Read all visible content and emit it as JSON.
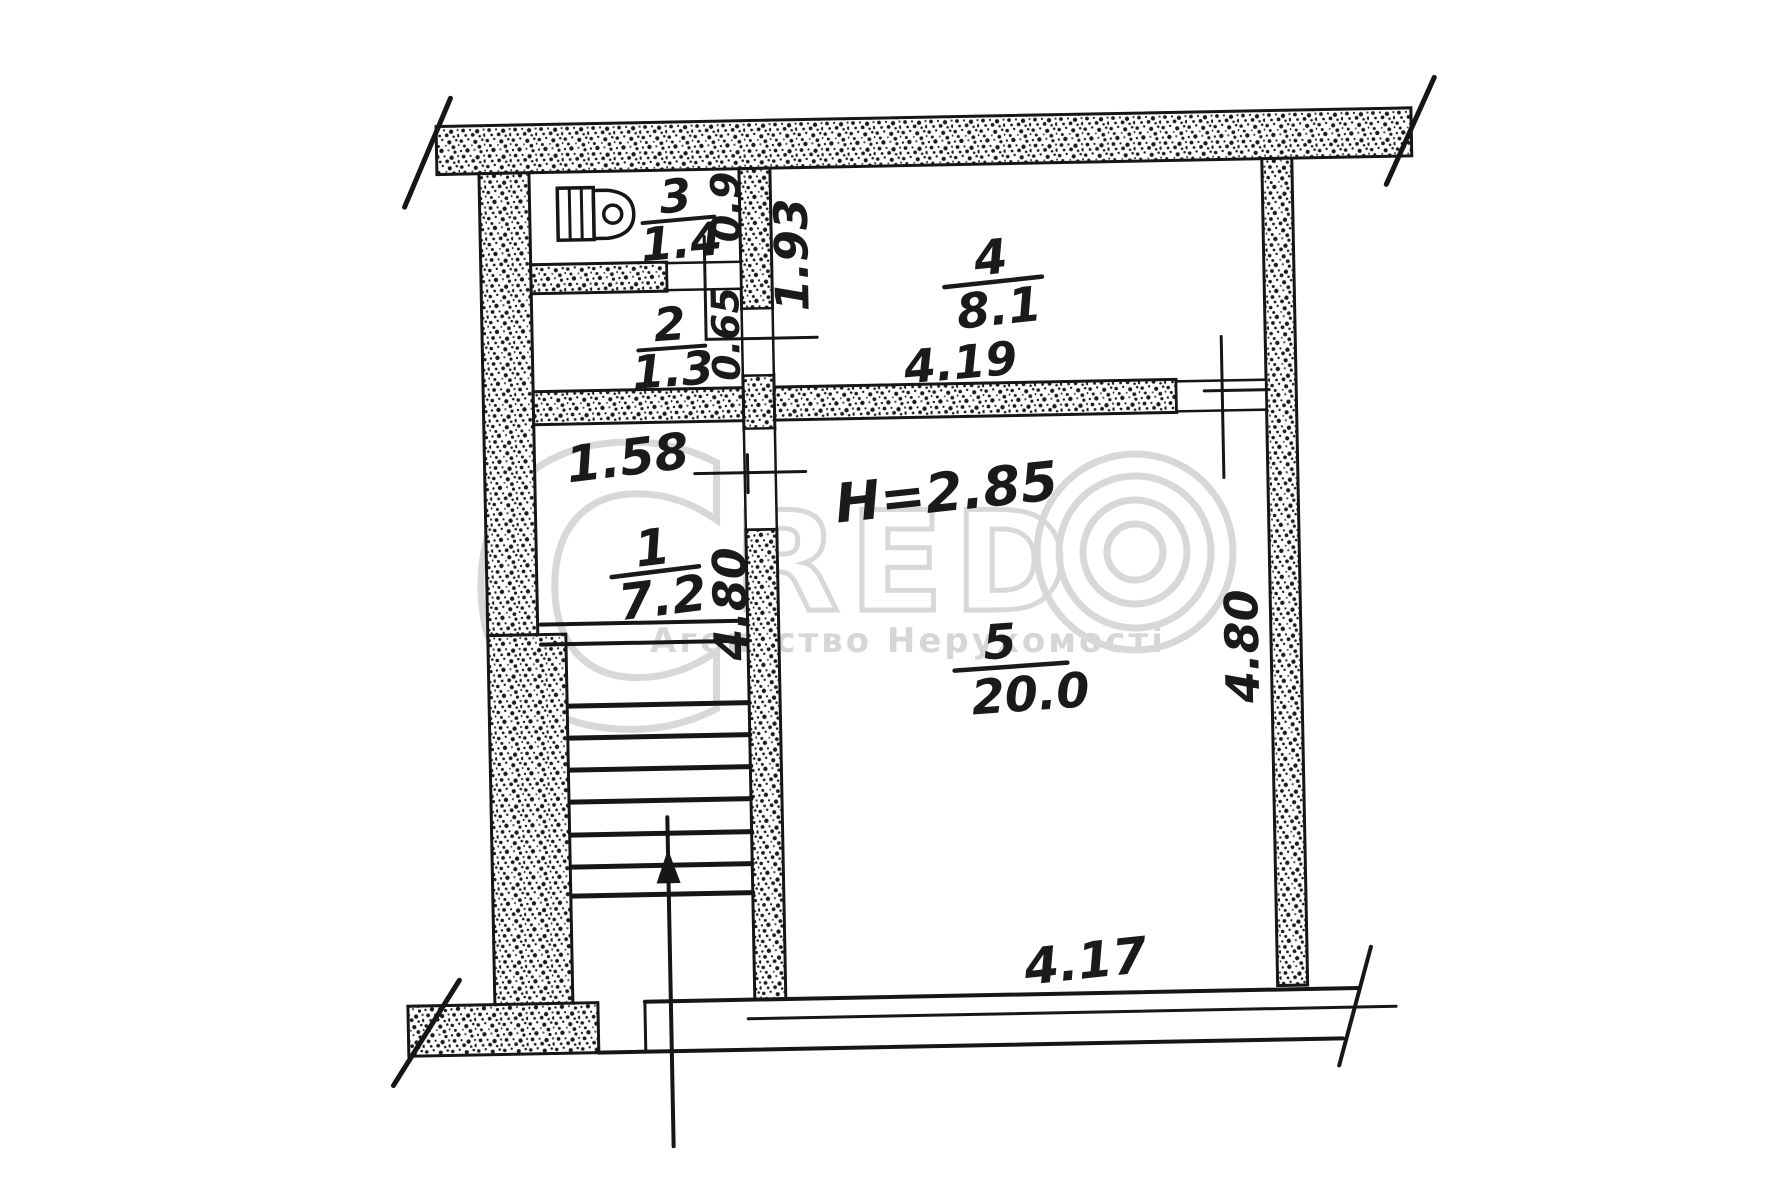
{
  "plan": {
    "room1": {
      "number": "1",
      "area": "7.2"
    },
    "room2": {
      "number": "2",
      "area": "1.3"
    },
    "room3": {
      "number": "3",
      "area": "1.4"
    },
    "room4": {
      "number": "4",
      "area": "8.1"
    },
    "room5": {
      "number": "5",
      "area": "20.0"
    },
    "dims": {
      "room3_depth": "0.9",
      "room2_door_width": "0.65",
      "room4_depth": "1.93",
      "room4_width": "4.19",
      "hall_width": "1.58",
      "ceiling_height": "H=2.85",
      "hall_depth": "4.80",
      "room5_depth": "4.80",
      "room5_width": "4.17"
    }
  },
  "watermark": {
    "letter_c": "C",
    "letters_red": "RED",
    "subtitle": "Агентство Нерухомості"
  },
  "colors": {
    "ink": "#1a1a1a",
    "watermark_gray": "#d4d4d4",
    "paper": "#ffffff"
  }
}
